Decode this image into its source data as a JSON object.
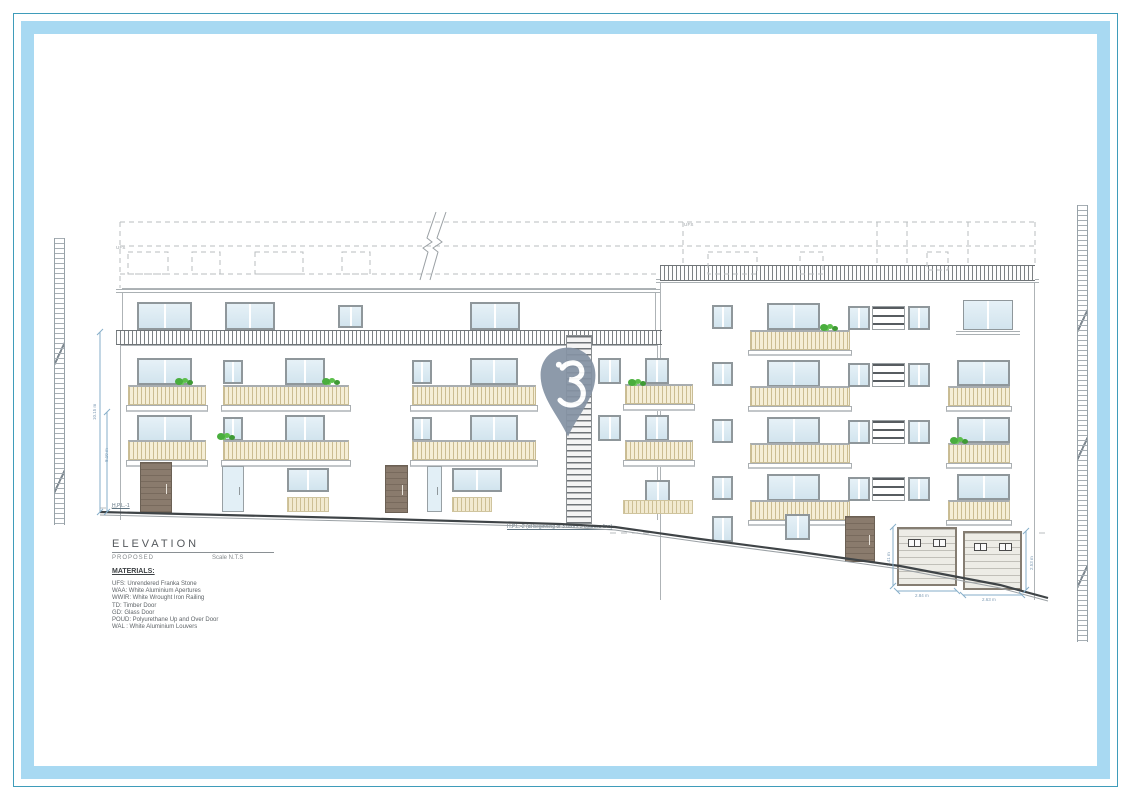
{
  "frame": {
    "band_color": "#a8d9f2",
    "line_color": "#3f9cba"
  },
  "title_block": {
    "title": "ELEVATION",
    "subtitle": "PROPOSED",
    "scale_label": "Scale N.T.S"
  },
  "materials": {
    "heading": "MATERIALS:",
    "items": [
      "UFS: Unrendered Franka Stone",
      "WAA: White Aluminium Apertures",
      "WWIR: White Wrought Iron Railing",
      "TD: Timber Door",
      "GD: Glass Door",
      "POUD: Polyurethane Up and Over Door",
      "WAL : White Aluminium Louvers"
    ]
  },
  "annotations": {
    "hpl1_label": "H.P.L.-1",
    "hpl2_note": "H.P.L.-2 (at beginning of 3 floors 3 courses line)",
    "ufs_tag": "UFS",
    "dim_height_outer": "10.15 m",
    "dim_height_inner": "8.10 m",
    "garage1_height": "2.41 m",
    "garage1_width": "2.84 m",
    "garage2_height": "2.53 m",
    "garage2_width": "2.63 m"
  },
  "watermark": {
    "icon_name": "location-pin",
    "color": "#8593a4"
  },
  "palette": {
    "balustrade": "#f5eed6",
    "glass": "#dcebf3",
    "timber_door": "#8a7b6d",
    "plant": "#4aae3e",
    "linework": "#9aa0a4"
  }
}
